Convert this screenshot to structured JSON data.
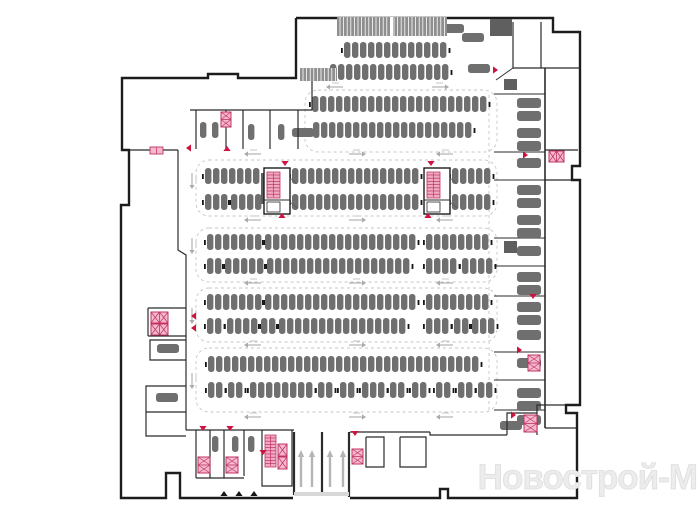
{
  "watermark": "Новострой-М",
  "colors": {
    "wall": "#1d1d1d",
    "inner": "#2b2b2b",
    "car": "#6f6f6f",
    "block": "#5f5f5f",
    "dash": "#c6c6c6",
    "pink": "#f5b9cd",
    "pink2": "#f0aac2",
    "crimson": "#c13366",
    "red": "#cf1340",
    "arrow": "#ababab",
    "ramp_arrow": "#b5b5b5",
    "hatch": "#8f8f8f",
    "threshold": "#d8d8d8",
    "black": "#151515"
  },
  "canvas": {
    "w": 700,
    "h": 525
  },
  "outline": [
    [
      [
        296,
        18
      ],
      [
        553,
        18
      ],
      [
        553,
        32
      ],
      [
        580,
        32
      ],
      [
        580,
        166
      ],
      [
        572,
        166
      ],
      [
        572,
        180
      ],
      [
        580,
        180
      ],
      [
        580,
        405
      ],
      [
        566,
        405
      ],
      [
        566,
        413
      ],
      [
        577,
        413
      ],
      [
        577,
        498
      ],
      [
        448,
        498
      ],
      [
        448,
        489
      ],
      [
        440,
        489
      ],
      [
        440,
        498
      ],
      [
        350,
        498
      ]
    ],
    [
      [
        293,
        498
      ],
      [
        180,
        498
      ],
      [
        180,
        473
      ],
      [
        166,
        473
      ],
      [
        166,
        498
      ],
      [
        121,
        498
      ],
      [
        121,
        205
      ],
      [
        129,
        205
      ],
      [
        129,
        150
      ],
      [
        122,
        150
      ],
      [
        122,
        78
      ],
      [
        208,
        78
      ],
      [
        208,
        74
      ],
      [
        238,
        74
      ],
      [
        238,
        78
      ],
      [
        296,
        78
      ],
      [
        296,
        18
      ]
    ]
  ],
  "inner_walls": [
    {
      "p": [
        [
          190,
          110
        ],
        [
          312,
          110
        ]
      ]
    },
    {
      "p": [
        [
          196,
          110
        ],
        [
          196,
          149
        ]
      ]
    },
    {
      "p": [
        [
          226,
          110
        ],
        [
          226,
          149
        ]
      ]
    },
    {
      "p": [
        [
          243,
          110
        ],
        [
          243,
          149
        ]
      ]
    },
    {
      "p": [
        [
          270,
          110
        ],
        [
          270,
          149
        ]
      ]
    },
    {
      "p": [
        [
          298,
          110
        ],
        [
          298,
          149
        ]
      ]
    },
    {
      "p": [
        [
          312,
          78
        ],
        [
          312,
          110
        ]
      ]
    },
    {
      "p": [
        [
          129,
          150
        ],
        [
          178,
          150
        ]
      ]
    },
    {
      "p": [
        [
          178,
          150
        ],
        [
          178,
          250
        ],
        [
          186,
          255
        ],
        [
          186,
          308
        ]
      ]
    },
    {
      "p": [
        [
          148,
          308
        ],
        [
          186,
          308
        ]
      ]
    },
    {
      "p": [
        [
          148,
          308
        ],
        [
          148,
          336
        ]
      ]
    },
    {
      "p": [
        [
          148,
          336
        ],
        [
          186,
          336
        ]
      ]
    },
    {
      "p": [
        [
          186,
          308
        ],
        [
          186,
          430
        ]
      ]
    },
    {
      "p": [
        [
          186,
          340
        ],
        [
          150,
          340
        ],
        [
          150,
          360
        ],
        [
          186,
          360
        ]
      ]
    },
    {
      "p": [
        [
          186,
          386
        ],
        [
          146,
          386
        ],
        [
          146,
          412
        ],
        [
          186,
          412
        ]
      ]
    },
    {
      "p": [
        [
          146,
          412
        ],
        [
          146,
          436
        ],
        [
          186,
          436
        ]
      ]
    },
    {
      "p": [
        [
          186,
          430
        ],
        [
          294,
          430
        ]
      ]
    },
    {
      "p": [
        [
          196,
          430
        ],
        [
          196,
          478
        ]
      ]
    },
    {
      "p": [
        [
          210,
          430
        ],
        [
          210,
          478
        ]
      ]
    },
    {
      "p": [
        [
          224,
          430
        ],
        [
          224,
          478
        ]
      ]
    },
    {
      "p": [
        [
          244,
          430
        ],
        [
          244,
          476
        ]
      ]
    },
    {
      "p": [
        [
          196,
          478
        ],
        [
          244,
          478
        ]
      ]
    },
    {
      "p": [
        [
          262,
          430
        ],
        [
          262,
          486
        ],
        [
          292,
          486
        ],
        [
          292,
          430
        ]
      ]
    },
    {
      "p": [
        [
          294,
          432
        ],
        [
          294,
          495
        ]
      ],
      "w": 2.2
    },
    {
      "p": [
        [
          322,
          432
        ],
        [
          322,
          495
        ]
      ],
      "w": 2.2
    },
    {
      "p": [
        [
          349,
          432
        ],
        [
          349,
          497
        ]
      ],
      "w": 2.2
    },
    {
      "p": [
        [
          350,
          432
        ],
        [
          430,
          432
        ]
      ]
    },
    {
      "p": [
        [
          366,
          437
        ],
        [
          384,
          437
        ],
        [
          384,
          467
        ],
        [
          366,
          467
        ],
        [
          366,
          437
        ]
      ]
    },
    {
      "p": [
        [
          400,
          437
        ],
        [
          426,
          437
        ],
        [
          426,
          467
        ],
        [
          400,
          467
        ],
        [
          400,
          437
        ]
      ]
    },
    {
      "p": [
        [
          430,
          432
        ],
        [
          430,
          435
        ],
        [
          507,
          435
        ]
      ]
    },
    {
      "p": [
        [
          507,
          435
        ],
        [
          507,
          413
        ],
        [
          537,
          413
        ]
      ]
    },
    {
      "p": [
        [
          537,
          435
        ],
        [
          537,
          405
        ],
        [
          566,
          405
        ]
      ]
    },
    {
      "p": [
        [
          545,
          68
        ],
        [
          545,
          428
        ]
      ],
      "w": 1.6
    },
    {
      "p": [
        [
          545,
          428
        ],
        [
          577,
          428
        ]
      ]
    },
    {
      "p": [
        [
          513,
          22
        ],
        [
          513,
          68
        ]
      ]
    },
    {
      "p": [
        [
          513,
          68
        ],
        [
          580,
          68
        ]
      ]
    },
    {
      "p": [
        [
          541,
          22
        ],
        [
          541,
          68
        ]
      ]
    },
    {
      "p": [
        [
          496,
          80
        ],
        [
          513,
          68
        ]
      ],
      "w": 0.9
    },
    {
      "p": [
        [
          545,
          150
        ],
        [
          578,
          150
        ]
      ]
    },
    {
      "p": [
        [
          545,
          180
        ],
        [
          572,
          180
        ]
      ]
    }
  ],
  "right_partitions": [
    94,
    152,
    180,
    238,
    266,
    296,
    352,
    380,
    410
  ],
  "right_cars": {
    "x": 517,
    "w": 24,
    "h": 10,
    "ys": [
      98,
      111,
      128,
      141,
      158,
      185,
      198,
      215,
      228,
      246,
      272,
      285,
      302,
      315,
      330,
      358,
      388,
      401,
      415
    ]
  },
  "island_bounds": [
    [
      305,
      90,
      192,
      62
    ],
    [
      196,
      160,
      301,
      56
    ],
    [
      196,
      228,
      301,
      54
    ],
    [
      196,
      288,
      301,
      54
    ],
    [
      196,
      348,
      301,
      64
    ]
  ],
  "dash_lines": [
    [
      [
        489,
        95
      ],
      [
        489,
        410
      ]
    ]
  ],
  "rows": [
    {
      "y": 42,
      "groups": [
        [
          344,
          13
        ]
      ]
    },
    {
      "y": 64,
      "groups": [
        [
          330,
          15
        ]
      ]
    },
    {
      "y": 96,
      "groups": [
        [
          312,
          22
        ]
      ]
    },
    {
      "y": 122,
      "groups": [
        [
          313,
          20
        ]
      ]
    },
    {
      "y": 168,
      "groups": [
        [
          205,
          7
        ],
        [
          292,
          16
        ],
        [
          452,
          5
        ]
      ]
    },
    {
      "y": 194,
      "groups": [
        [
          205,
          3
        ],
        [
          231,
          4
        ],
        [
          292,
          16
        ],
        [
          452,
          5
        ]
      ]
    },
    {
      "y": 234,
      "groups": [
        [
          207,
          7
        ],
        [
          265,
          19
        ],
        [
          426,
          8
        ]
      ]
    },
    {
      "y": 258,
      "groups": [
        [
          207,
          2
        ],
        [
          225,
          5
        ],
        [
          267,
          18
        ],
        [
          426,
          4
        ],
        [
          462,
          4
        ]
      ]
    },
    {
      "y": 294,
      "groups": [
        [
          207,
          7
        ],
        [
          265,
          19
        ],
        [
          426,
          8
        ]
      ]
    },
    {
      "y": 318,
      "groups": [
        [
          207,
          2
        ],
        [
          227,
          4
        ],
        [
          261,
          2
        ],
        [
          279,
          16
        ],
        [
          426,
          3
        ],
        [
          454,
          2
        ],
        [
          472,
          3
        ]
      ]
    },
    {
      "y": 356,
      "groups": [
        [
          208,
          34
        ]
      ]
    },
    {
      "y": 382,
      "groups": [
        [
          208,
          2
        ],
        [
          228,
          2
        ],
        [
          250,
          8
        ],
        [
          318,
          2
        ],
        [
          340,
          2
        ],
        [
          362,
          3
        ],
        [
          390,
          2
        ],
        [
          412,
          2
        ],
        [
          436,
          2
        ],
        [
          458,
          2
        ],
        [
          478,
          2
        ]
      ]
    }
  ],
  "vcars": [
    [
      200,
      122
    ],
    [
      212,
      122
    ],
    [
      248,
      124
    ],
    [
      278,
      124
    ],
    [
      212,
      436
    ],
    [
      232,
      436
    ],
    [
      248,
      436
    ]
  ],
  "hcars": [
    [
      442,
      24
    ],
    [
      462,
      33
    ],
    [
      468,
      64
    ],
    [
      292,
      128
    ],
    [
      157,
      344
    ],
    [
      156,
      393
    ],
    [
      500,
      421
    ]
  ],
  "stair_cores": [
    [
      264,
      168
    ],
    [
      424,
      168
    ]
  ],
  "stair_shafts": [
    [
      265,
      435,
      11,
      32
    ]
  ],
  "xboxes": [
    {
      "x": 151,
      "y": 312,
      "w": 17,
      "h": 11,
      "cx": 2,
      "cy": 1
    },
    {
      "x": 151,
      "y": 324,
      "w": 17,
      "h": 11,
      "cx": 2,
      "cy": 1
    },
    {
      "x": 221,
      "y": 112,
      "w": 10,
      "h": 15,
      "cx": 1,
      "cy": 2
    },
    {
      "x": 198,
      "y": 457,
      "w": 12,
      "h": 16,
      "cx": 1,
      "cy": 2
    },
    {
      "x": 226,
      "y": 457,
      "w": 12,
      "h": 16,
      "cx": 1,
      "cy": 2
    },
    {
      "x": 278,
      "y": 444,
      "w": 9,
      "h": 12,
      "cx": 1,
      "cy": 1
    },
    {
      "x": 278,
      "y": 457,
      "w": 9,
      "h": 12,
      "cx": 1,
      "cy": 1
    },
    {
      "x": 352,
      "y": 449,
      "w": 11,
      "h": 15,
      "cx": 1,
      "cy": 2
    },
    {
      "x": 549,
      "y": 151,
      "w": 15,
      "h": 11,
      "cx": 2,
      "cy": 1
    },
    {
      "x": 528,
      "y": 355,
      "w": 12,
      "h": 16,
      "cx": 1,
      "cy": 2
    },
    {
      "x": 524,
      "y": 415,
      "w": 13,
      "h": 17,
      "cx": 1,
      "cy": 2
    }
  ],
  "triangles": [
    {
      "x": 285,
      "y": 161,
      "d": "d"
    },
    {
      "x": 431,
      "y": 161,
      "d": "d"
    },
    {
      "x": 282,
      "y": 213,
      "d": "u"
    },
    {
      "x": 428,
      "y": 213,
      "d": "u"
    },
    {
      "x": 227,
      "y": 146,
      "d": "u"
    },
    {
      "x": 186,
      "y": 148,
      "d": "l"
    },
    {
      "x": 191,
      "y": 316,
      "d": "l"
    },
    {
      "x": 191,
      "y": 328,
      "d": "l"
    },
    {
      "x": 493,
      "y": 70,
      "d": "r"
    },
    {
      "x": 523,
      "y": 155,
      "d": "r"
    },
    {
      "x": 517,
      "y": 350,
      "d": "r"
    },
    {
      "x": 511,
      "y": 415,
      "d": "r"
    },
    {
      "x": 533,
      "y": 294,
      "d": "d"
    },
    {
      "x": 203,
      "y": 426,
      "d": "d"
    },
    {
      "x": 230,
      "y": 426,
      "d": "d"
    },
    {
      "x": 355,
      "y": 431,
      "d": "d"
    },
    {
      "x": 263,
      "y": 450,
      "d": "d"
    }
  ],
  "black_triangles": [
    [
      224,
      491
    ],
    [
      239,
      491
    ],
    [
      254,
      491
    ]
  ],
  "lane_arrows_h": [
    [
      330,
      87,
      "l"
    ],
    [
      445,
      87,
      "r"
    ],
    [
      248,
      154,
      "l"
    ],
    [
      362,
      154,
      "r"
    ],
    [
      440,
      154,
      "l"
    ],
    [
      248,
      220,
      "l"
    ],
    [
      362,
      220,
      "r"
    ],
    [
      440,
      220,
      "l"
    ],
    [
      248,
      283,
      "l"
    ],
    [
      362,
      283,
      "r"
    ],
    [
      440,
      283,
      "l"
    ],
    [
      248,
      345,
      "l"
    ],
    [
      362,
      345,
      "r"
    ],
    [
      440,
      345,
      "l"
    ],
    [
      248,
      417,
      "l"
    ],
    [
      362,
      417,
      "r"
    ],
    [
      440,
      417,
      "l"
    ]
  ],
  "lane_arrows_v": [
    [
      192,
      185
    ],
    [
      192,
      250
    ],
    [
      192,
      320
    ],
    [
      192,
      385
    ]
  ],
  "ramp": {
    "arrows_x": [
      301,
      312,
      330,
      343
    ],
    "y_bottom": 487,
    "y_top": 450,
    "threshold": [
      294,
      492,
      55,
      4
    ]
  },
  "hatches": [
    [
      337,
      17,
      110,
      19
    ],
    [
      300,
      68,
      37,
      13
    ]
  ],
  "hatch_gaps": [
    [
      390,
      17,
      3,
      19
    ]
  ],
  "pink_door": [
    150,
    147,
    13,
    7
  ],
  "blocks": [
    [
      261,
      173,
      6,
      31
    ],
    [
      490,
      19,
      22,
      17
    ],
    [
      504,
      79,
      13,
      11
    ],
    [
      504,
      241,
      13,
      12
    ]
  ]
}
